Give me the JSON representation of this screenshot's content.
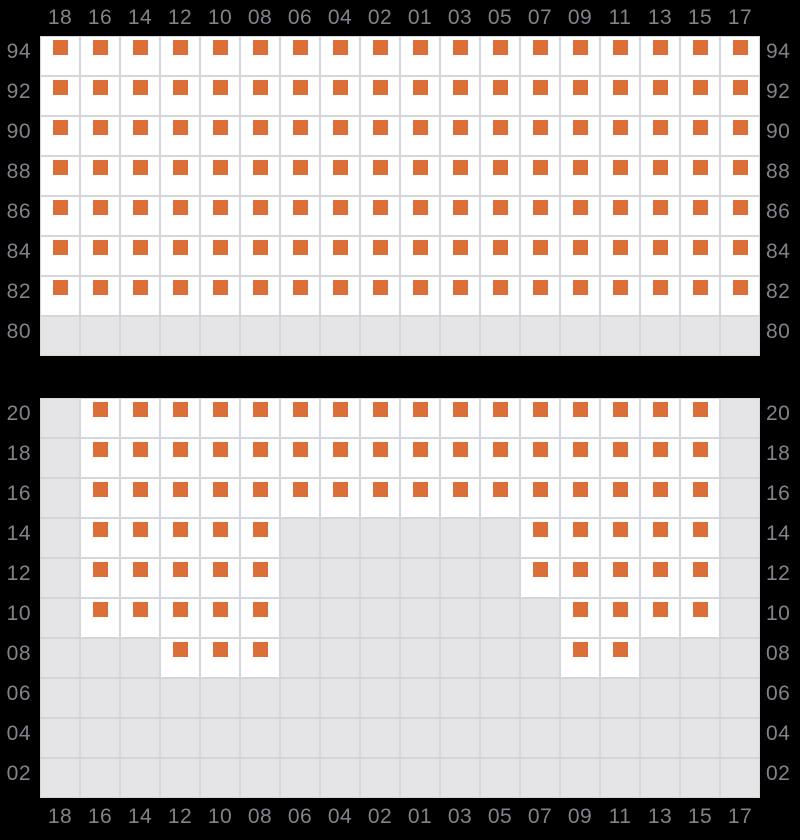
{
  "colors": {
    "background": "#000000",
    "grid_line": "#d6d6da",
    "cell_available_bg": "#ffffff",
    "cell_blocked_bg": "#e5e5e8",
    "marker_orange": "#dc6f38",
    "label_text": "#82828a"
  },
  "cell_states": {
    "O": "available (white cell with orange square marker)",
    "X": "unavailable (gray cell, no marker)"
  },
  "columns": [
    "18",
    "16",
    "14",
    "12",
    "10",
    "08",
    "06",
    "04",
    "02",
    "01",
    "03",
    "05",
    "07",
    "09",
    "11",
    "13",
    "15",
    "17"
  ],
  "panels": [
    {
      "id": "upper",
      "column_labels_position": "top",
      "rows": [
        {
          "label": "94",
          "cells": "OOOOOOOOOOOOOOOOOO"
        },
        {
          "label": "92",
          "cells": "OOOOOOOOOOOOOOOOOO"
        },
        {
          "label": "90",
          "cells": "OOOOOOOOOOOOOOOOOO"
        },
        {
          "label": "88",
          "cells": "OOOOOOOOOOOOOOOOOO"
        },
        {
          "label": "86",
          "cells": "OOOOOOOOOOOOOOOOOO"
        },
        {
          "label": "84",
          "cells": "OOOOOOOOOOOOOOOOOO"
        },
        {
          "label": "82",
          "cells": "OOOOOOOOOOOOOOOOOO"
        },
        {
          "label": "80",
          "cells": "XXXXXXXXXXXXXXXXXX"
        }
      ]
    },
    {
      "id": "lower",
      "column_labels_position": "bottom",
      "rows": [
        {
          "label": "20",
          "cells": "XOOOOOOOOOOOOOOOOX"
        },
        {
          "label": "18",
          "cells": "XOOOOOOOOOOOOOOOOX"
        },
        {
          "label": "16",
          "cells": "XOOOOOOOOOOOOOOOOX"
        },
        {
          "label": "14",
          "cells": "XOOOOOXXXXXXOOOOOX"
        },
        {
          "label": "12",
          "cells": "XOOOOOXXXXXXOOOOOX"
        },
        {
          "label": "10",
          "cells": "XOOOOOXXXXXXXOOOOX"
        },
        {
          "label": "08",
          "cells": "XXXOOOXXXXXXXOOXXX"
        },
        {
          "label": "06",
          "cells": "XXXXXXXXXXXXXXXXXX"
        },
        {
          "label": "04",
          "cells": "XXXXXXXXXXXXXXXXXX"
        },
        {
          "label": "02",
          "cells": "XXXXXXXXXXXXXXXXXX"
        }
      ]
    }
  ]
}
